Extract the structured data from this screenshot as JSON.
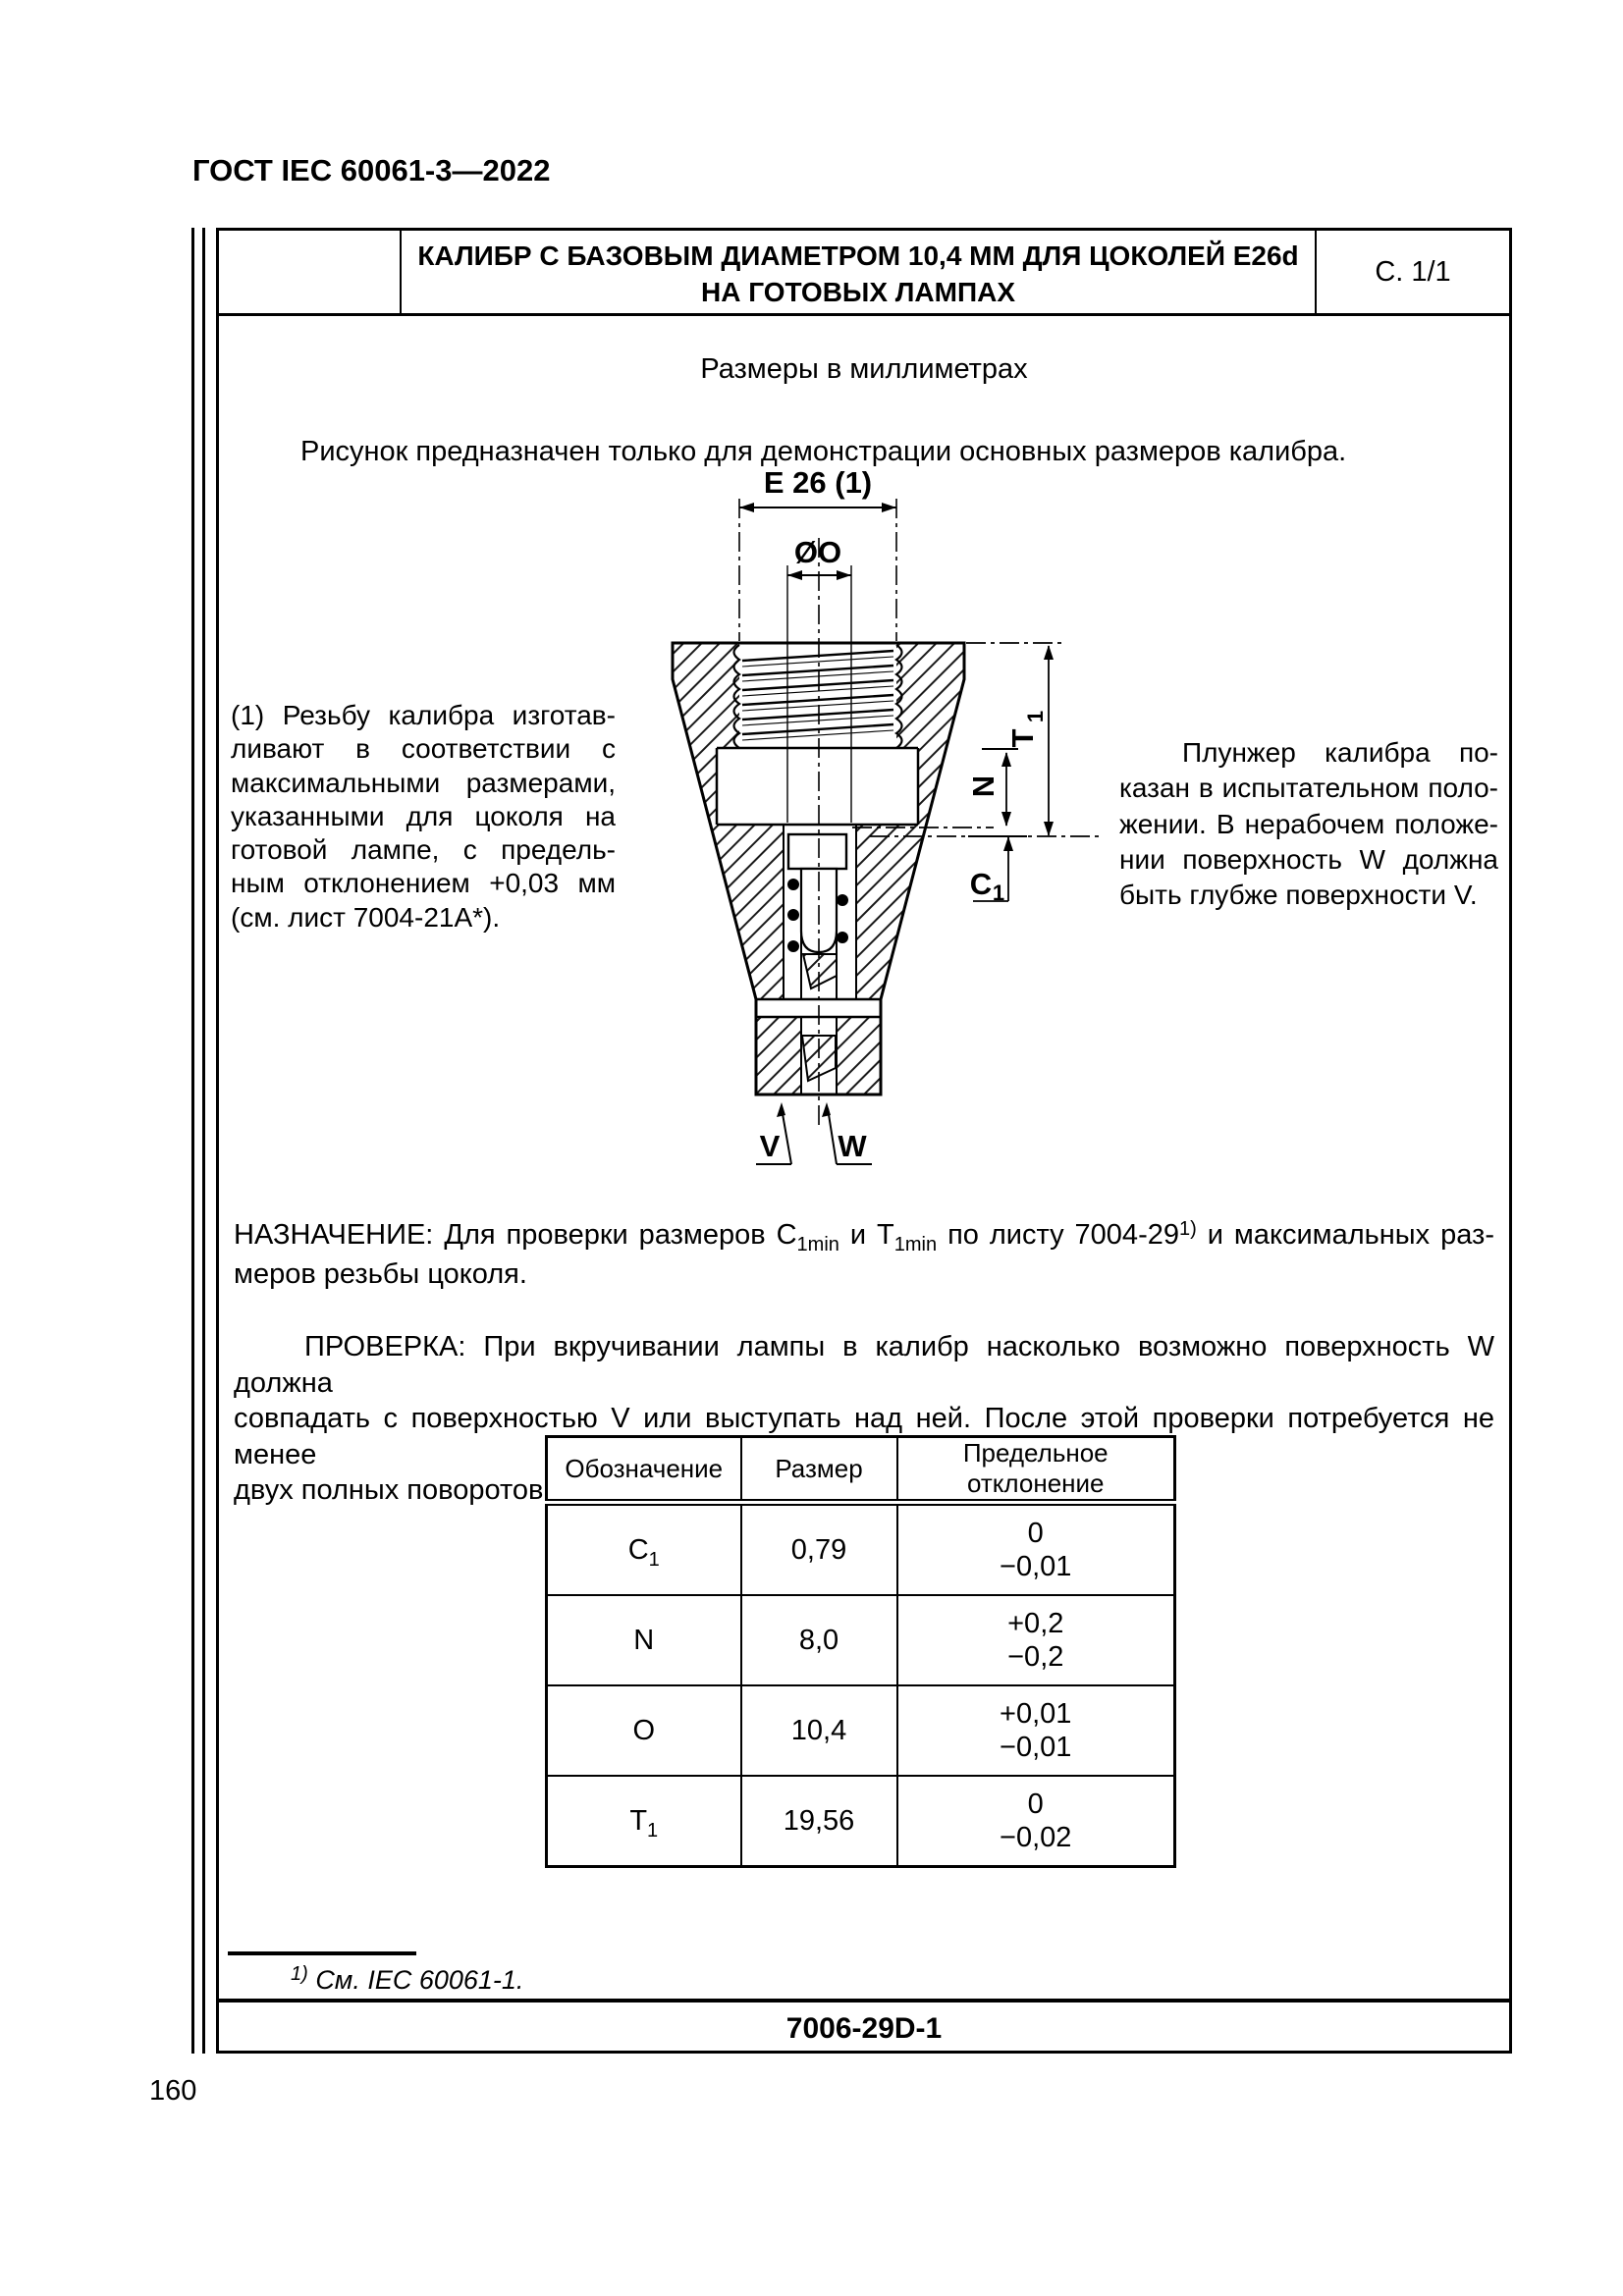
{
  "colors": {
    "ink": "#000000",
    "paper": "#ffffff"
  },
  "header": {
    "standard_ref": "ГОСТ IEC 60061-3—2022"
  },
  "title_block": {
    "title_line1": "КАЛИБР С БАЗОВЫМ ДИАМЕТРОМ 10,4 ММ ДЛЯ ЦОКОЛЕЙ E26d",
    "title_line2": "НА ГОТОВЫХ ЛАМПАХ",
    "sheet": "С. 1/1"
  },
  "intro": {
    "units_note": "Размеры в миллиметрах",
    "figure_note": "Рисунок предназначен только для демонстрации основных размеров калибра."
  },
  "drawing": {
    "labels": {
      "e26": "E 26 (1)",
      "diameter_o": "ØO",
      "t1_main": "T",
      "t1_sub": "1",
      "n": "N",
      "c1_main": "C",
      "c1_sub": "1",
      "v": "V",
      "w": "W"
    }
  },
  "notes": {
    "left_lines": [
      "(1) Резьбу калибра изготав-",
      "ливают в соответствии с",
      "максимальными размерами,",
      "указанными для цоколя на",
      "готовой лампе, с предель-",
      "ным отклонением +0,03 мм",
      "(см. лист 7004-21А*)."
    ],
    "right_lines": [
      "Плунжер калибра по-",
      "казан в испытательном поло-",
      "жении. В нерабочем положе-",
      "нии поверхность W должна",
      "быть глубже поверхности V."
    ]
  },
  "purpose": {
    "lead": "НАЗНАЧЕНИЕ: Для проверки размеров C",
    "sub1": "1min",
    "mid1": " и T",
    "sub2": "1min",
    "mid2": " по листу 7004-29",
    "sup": "1)",
    "tail": " и максимальных раз-",
    "line2": "меров резьбы цоколя."
  },
  "check": {
    "lines": [
      "ПРОВЕРКА: При вкручивании лампы в калибр насколько возможно поверхность W должна",
      "совпадать с поверхностью V или выступать над ней. После этой проверки потребуется не менее",
      "двух полных поворотов лампы для отделения ее от калибра."
    ]
  },
  "table": {
    "headers": [
      "Обозначение",
      "Размер",
      "Предельное отклонение"
    ],
    "rows": [
      {
        "sym": "C",
        "sym_sub": "1",
        "size": "0,79",
        "dev_plus": "0",
        "dev_minus": "−0,01"
      },
      {
        "sym": "N",
        "sym_sub": "",
        "size": "8,0",
        "dev_plus": "+0,2",
        "dev_minus": "−0,2"
      },
      {
        "sym": "O",
        "sym_sub": "",
        "size": "10,4",
        "dev_plus": "+0,01",
        "dev_minus": "−0,01"
      },
      {
        "sym": "T",
        "sym_sub": "1",
        "size": "19,56",
        "dev_plus": "0",
        "dev_minus": "−0,02"
      }
    ]
  },
  "footnote": {
    "marker": "1)",
    "text": "См. IEC 60061-1."
  },
  "footer": {
    "sheet_code": "7006-29D-1",
    "page_number": "160"
  }
}
